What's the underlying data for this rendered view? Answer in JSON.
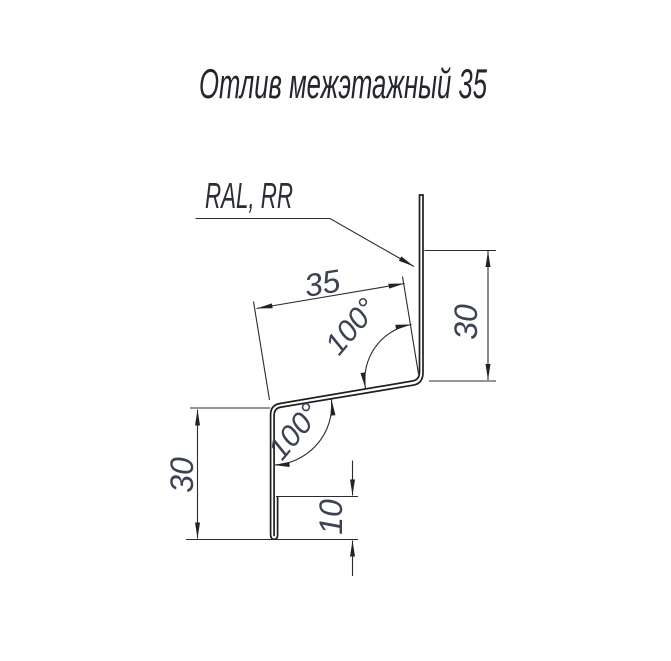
{
  "title": "Отлив межэтажный 35",
  "callout": {
    "material_label": "RAL, RR"
  },
  "dimensions": {
    "slant_width_mm": "35",
    "upper_flange_height_mm": "30",
    "left_face_height_mm": "30",
    "bottom_hem_mm": "10",
    "upper_bend_angle": "100°",
    "lower_bend_angle": "100°"
  },
  "colors": {
    "background": "#ffffff",
    "line": "#2b2b2b",
    "profile_line": "#1f1f1f",
    "dimension_text": "#3a4254",
    "title_text": "#23262c"
  }
}
